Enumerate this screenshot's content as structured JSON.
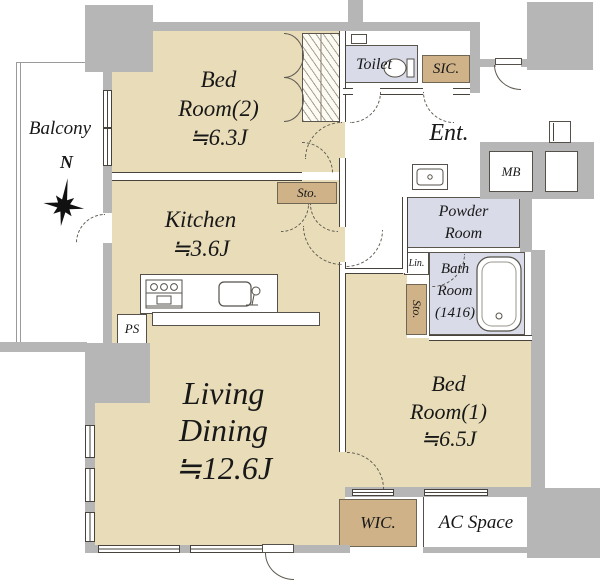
{
  "title": "apartment-floor-plan",
  "palette": {
    "floor": "#e9ddb9",
    "closet": "#d0b289",
    "wet": "#d9dce8",
    "wall": "#b6b6b6",
    "arc": "#5f5b52"
  },
  "compass": {
    "north_label": "N"
  },
  "rooms": {
    "balcony": {
      "label": "Balcony"
    },
    "bedroom2": {
      "lines": [
        "Bed",
        "Room(2)",
        "≒6.3J"
      ]
    },
    "kitchen": {
      "lines": [
        "Kitchen",
        "≒3.6J"
      ]
    },
    "sto_kitchen": {
      "label": "Sto."
    },
    "toilet": {
      "label": "Toilet"
    },
    "sic": {
      "label": "SIC."
    },
    "entrance": {
      "label": "Ent."
    },
    "mb": {
      "label": "MB"
    },
    "powder_room": {
      "lines": [
        "Powder",
        "Room"
      ]
    },
    "linen": {
      "label": "Lin."
    },
    "sto_bath": {
      "label": "Sto."
    },
    "bathroom": {
      "lines": [
        "Bath",
        "Room",
        "(1416)"
      ]
    },
    "living_dining": {
      "lines": [
        "Living",
        "Dining",
        "≒12.6J"
      ]
    },
    "bedroom1": {
      "lines": [
        "Bed",
        "Room(1)",
        "≒6.5J"
      ]
    },
    "wic": {
      "label": "WIC."
    },
    "ac_space": {
      "label": "AC Space"
    },
    "ps": {
      "label": "PS"
    }
  }
}
